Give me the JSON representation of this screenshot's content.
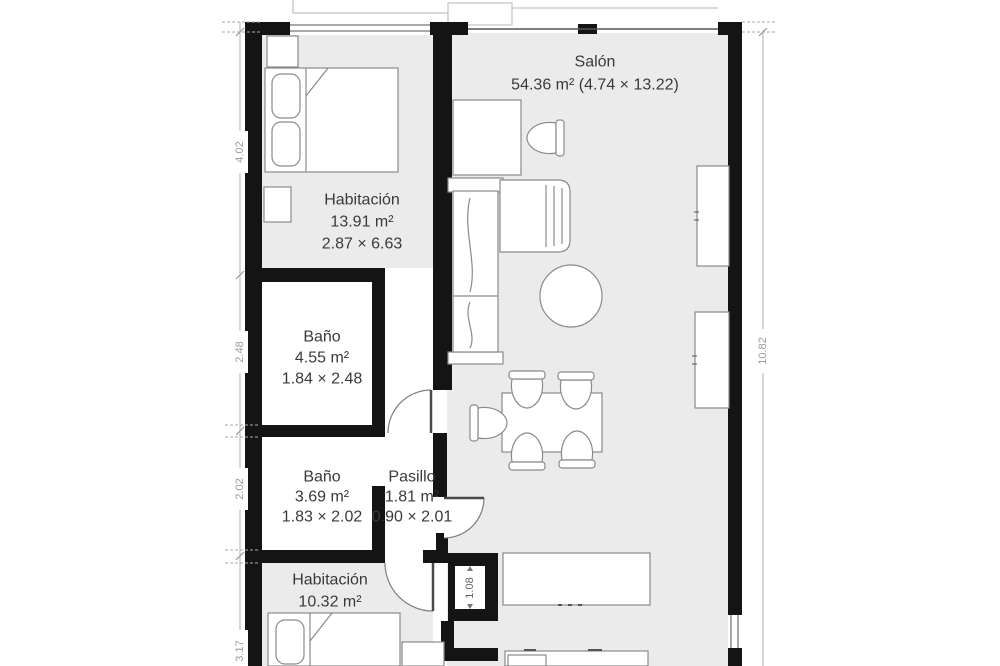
{
  "plan": {
    "type": "floorplan",
    "colors": {
      "background": "#ffffff",
      "floor": "#ebebeb",
      "wall": "#141414",
      "furniture_stroke": "#8a8a8a",
      "label": "#3a3a3a",
      "dimension": "#9a9a9a"
    },
    "rooms": [
      {
        "id": "salon",
        "name": "Salón",
        "area": "54.36 m² (4.74 × 13.22)"
      },
      {
        "id": "habitacion1",
        "name": "Habitación",
        "area": "13.91 m²",
        "dims": "2.87 × 6.63"
      },
      {
        "id": "bano1",
        "name": "Baño",
        "area": "4.55 m²",
        "dims": "1.84 × 2.48"
      },
      {
        "id": "bano2",
        "name": "Baño",
        "area": "3.69 m²",
        "dims": "1.83 × 2.02"
      },
      {
        "id": "pasillo",
        "name": "Pasillo",
        "area": "1.81 m²",
        "dims": "0.90 × 2.01"
      },
      {
        "id": "habitacion2",
        "name": "Habitación",
        "area": "10.32 m²"
      }
    ],
    "dimensions": {
      "left": [
        "4.02",
        "2.48",
        "2.02",
        "3.17"
      ],
      "right": [
        "10.82"
      ],
      "shaft": "1.08"
    }
  }
}
